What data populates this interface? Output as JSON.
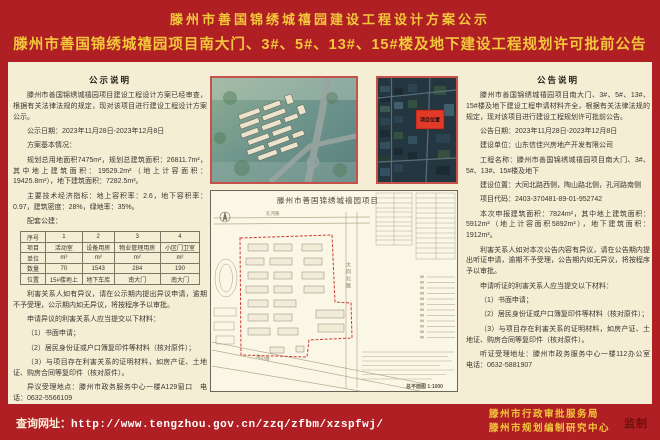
{
  "banner": {
    "title_line1": "滕州市善国锦绣城禧园建设工程设计方案公示",
    "title_line2": "滕州市善国锦绣城禧园项目南大门、3#、5#、13#、15#楼及地下建设工程规划许可批前公告"
  },
  "left_panel": {
    "title": "公示说明",
    "paragraphs": [
      "滕州市善国锦绣城禧园项目建设工程设计方案已经审查，根据有关法律法规的规定，现对该项目进行建设工程设计方案公示。",
      "公示日期：2023年11月28日-2023年12月8日",
      "方案基本情况：",
      "规划总用地面积7475m²，规划总建筑面积：26811.7m²，其中地上建筑面积：19529.2m²（地上计容面积：19425.8m²），地下建筑面积：7282.5m²。",
      "主要技术经济指标：地上容积率：2.6，地下容积率：0.97，建筑密度：28%，绿地率：35%。",
      "配套公建："
    ],
    "table": {
      "rows": [
        [
          "序号",
          "1",
          "2",
          "3",
          "4"
        ],
        [
          "项目",
          "活动室",
          "设备用房",
          "物业管理用房",
          "小区门卫室"
        ],
        [
          "单位",
          "m²",
          "m²",
          "m²",
          "m²"
        ],
        [
          "数量",
          "70",
          "1543",
          "284",
          "190"
        ],
        [
          "位置",
          "15#楼地上",
          "地下车库",
          "南大门",
          "南大门"
        ]
      ]
    },
    "paragraphs_after": [
      "利害关系人如有异议，请在公示期内提出异议申请，逾期不予受理，公示期内如无异议，将按程序予以审批。",
      "申请异议的利害关系人应当提交以下材料：",
      "（1）书面申请；",
      "（2）居民身份证或户口簿复印件等材料（核对原件）；",
      "（3）与项目存在利害关系的证明材料，如房产证、土地证、购房合同等复印件（核对原件）。",
      "异议受理地点：滕州市政务服务中心一楼A129窗口　电话：0632-5566109"
    ]
  },
  "middle": {
    "satellite_marker": "项目位置",
    "siteplan": {
      "title": "滕州市善国锦绣城禧园项目",
      "road_top": "孔河路",
      "road_right": "大同北路",
      "road_bottom": "陶山路",
      "scale_label": "总平面图 1:1000"
    }
  },
  "right_panel": {
    "title": "公告说明",
    "paragraphs": [
      "滕州市善国锦绣城禧园项目南大门、3#、5#、13#、15#楼及地下建设工程申请材料齐全，根据有关法律法规的规定，现对该项目进行建设工程规划许可批前公告。",
      "公告日期：2023年11月28日-2023年12月8日",
      "建设单位：山东信佳兴房地产开发有限公司",
      "工程名称：滕州市善国锦绣城禧园项目南大门、3#、5#、13#、15#楼及地下",
      "建设位置：大同北路西侧，陶山路北侧，孔河路南侧",
      "项目代码：2403-370481-89-01-952742",
      "本次申报建筑面积：7824m²，其中地上建筑面积：5912m²（地上计容面积5892m²），地下建筑面积：1912m²。",
      "利害关系人如对本次公告内容有异议，请在公告期内提出听证申请，逾期不予受理，公告期内如无异议，将按程序予以审批。",
      "申请听证的利害关系人应当提交以下材料：",
      "（1）书面申请；",
      "（2）居民身份证或户口簿复印件等材料（核对原件）；",
      "（3）与项目存在利害关系的证明材料，如房产证、土地证、购房合同等复印件（核对原件）。",
      "听证受理地址：滕州市政务服务中心一楼112办公室　电话：0632-5881907"
    ]
  },
  "bottom_bar": {
    "query_label": "查询网址：",
    "url": "http://www.tengzhou.gov.cn/zzq/zfbm/xzspfwj/",
    "org_line1": "滕州市行政审批服务局",
    "org_line2": "滕州市规划编制研究中心",
    "seal": "监制"
  },
  "colors": {
    "frame_red": "#b01f23",
    "title_yellow": "#f3c73b",
    "paper_cream": "#f6eed4",
    "seal_red": "#6d130c",
    "marker_red": "#e23a28"
  }
}
